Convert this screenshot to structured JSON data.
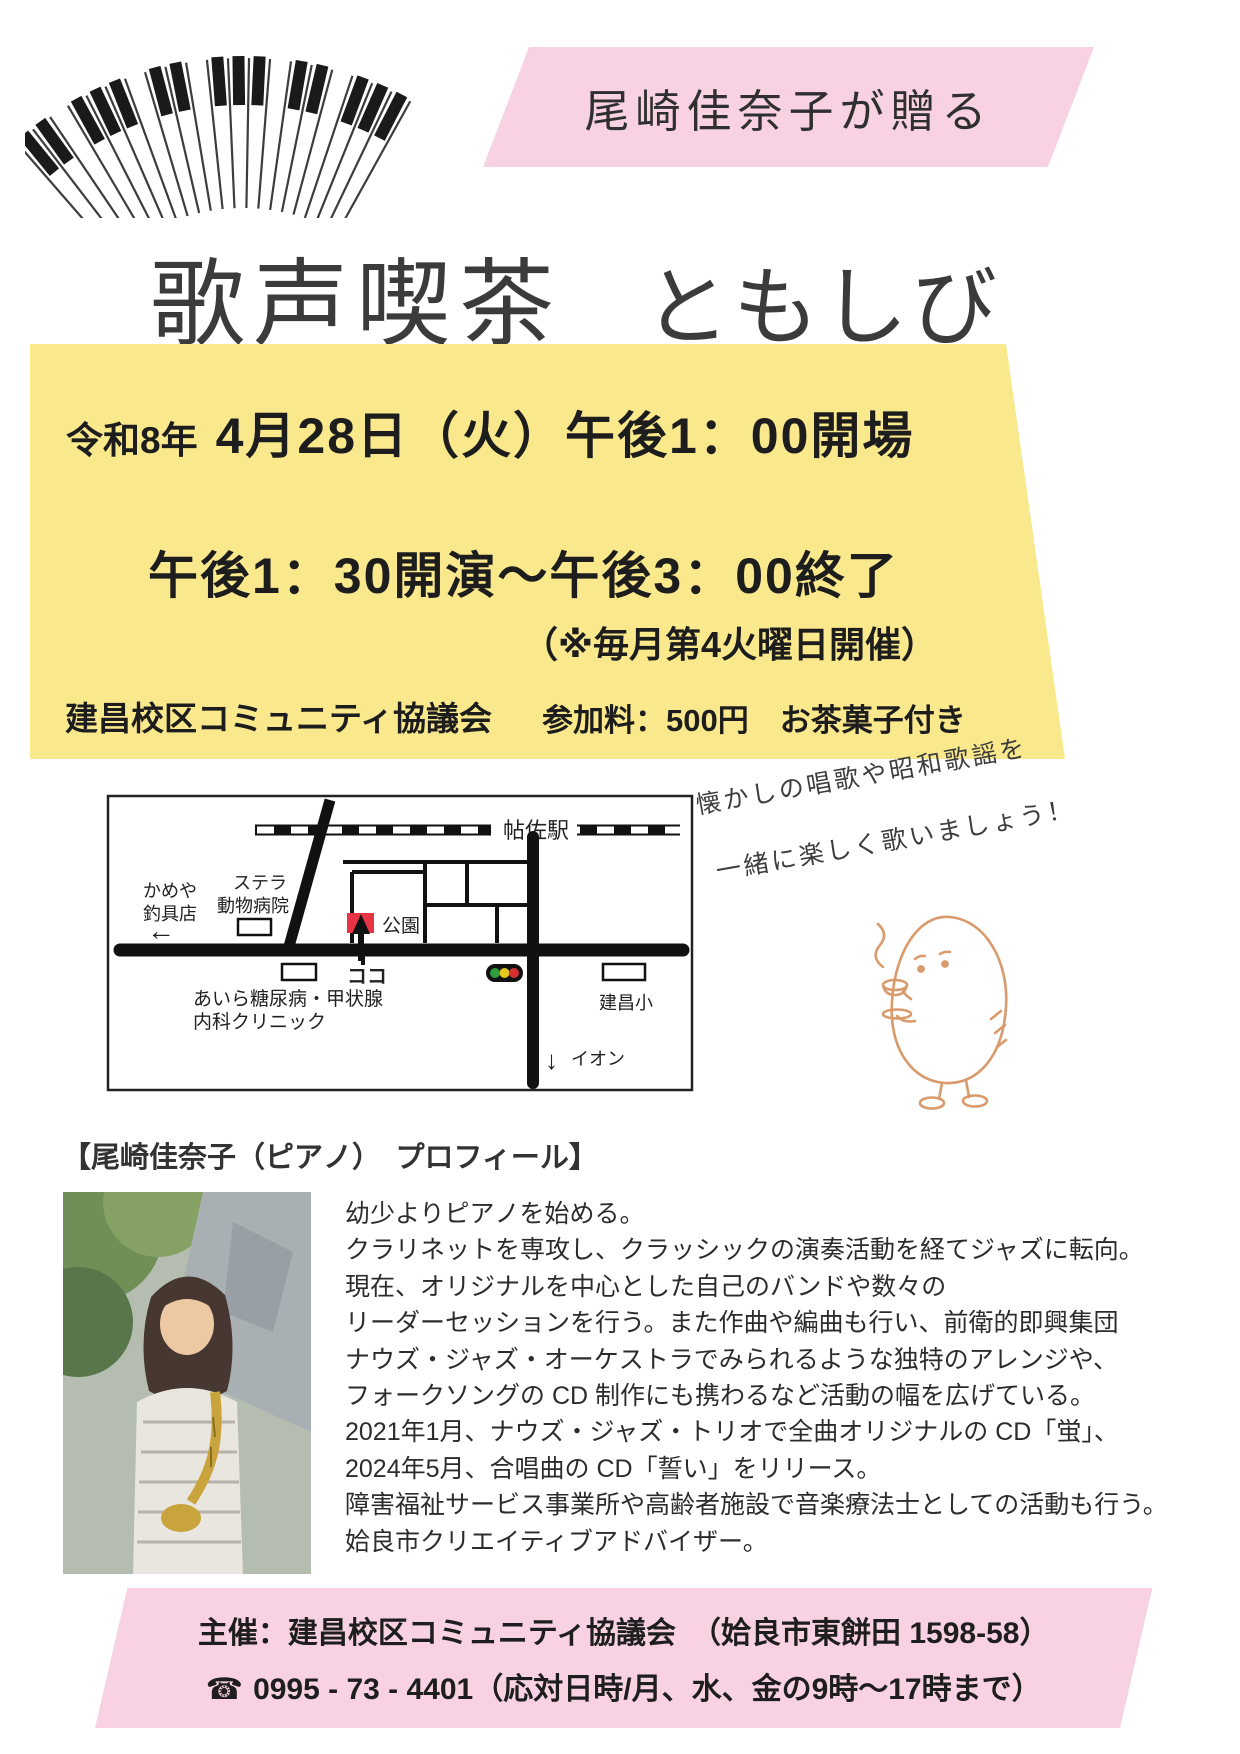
{
  "banner_top": {
    "text": "尾崎佳奈子が贈る"
  },
  "title": {
    "main": "歌声喫茶",
    "sub": "ともしび"
  },
  "event_box": {
    "era": "令和8年",
    "date_line": "4月28日（火）午後1：00開場",
    "time_line": "午後1：30開演～午後3：00終了",
    "note": "（※毎月第4火曜日開催）",
    "organizer": "建昌校区コミュニティ協議会",
    "fee": "参加料：500円　お茶菓子付き"
  },
  "map": {
    "station": "帖佐駅",
    "shop_line1": "かめや",
    "shop_line2": "釣具店",
    "arrow_left": "←",
    "vet_line1": "ステラ",
    "vet_line2": "動物病院",
    "park": "公園",
    "here": "ココ",
    "clinic_line1": "あいら糖尿病・甲状腺",
    "clinic_line2": "内科クリニック",
    "school": "建昌小",
    "arrow_down": "↓",
    "aeon": "イオン"
  },
  "slogan": {
    "line1": "懐かしの唱歌や昭和歌謡を",
    "line2": "一緒に楽しく歌いましょう！"
  },
  "profile": {
    "heading": "【尾崎佳奈子（ピアノ）　プロフィール】",
    "lines": [
      "幼少よりピアノを始める。",
      "クラリネットを専攻し、クラッシックの演奏活動を経てジャズに転向。",
      "現在、オリジナルを中心とした自己のバンドや数々の",
      "リーダーセッションを行う。また作曲や編曲も行い、前衛的即興集団",
      "ナウズ・ジャズ・オーケストラでみられるような独特のアレンジや、",
      "フォークソングの CD 制作にも携わるなど活動の幅を広げている。",
      "2021年1月、ナウズ・ジャズ・トリオで全曲オリジナルの CD「蛍」、",
      "2024年5月、合唱曲の CD「誓い」をリリース。",
      "障害福祉サービス事業所や高齢者施設で音楽療法士としての活動も行う。",
      "姶良市クリエイティブアドバイザー。"
    ]
  },
  "footer": {
    "organizer_line": "主催：建昌校区コミュニティ協議会　（姶良市東餅田 1598-58）",
    "phone_icon": "☎",
    "phone_line": "0995 - 73 - 4401（応対日時/月、水、金の9時～17時まで）"
  },
  "colors": {
    "banner_pink": "#f8d2e2",
    "event_yellow": "#fae88d",
    "marker_red": "#e73444",
    "traffic_green": "#2e9e3e",
    "traffic_yellow": "#e5c61f",
    "traffic_red": "#d33030",
    "mascot_stroke": "#d99a6c",
    "text_dark": "#1d1d1d"
  }
}
